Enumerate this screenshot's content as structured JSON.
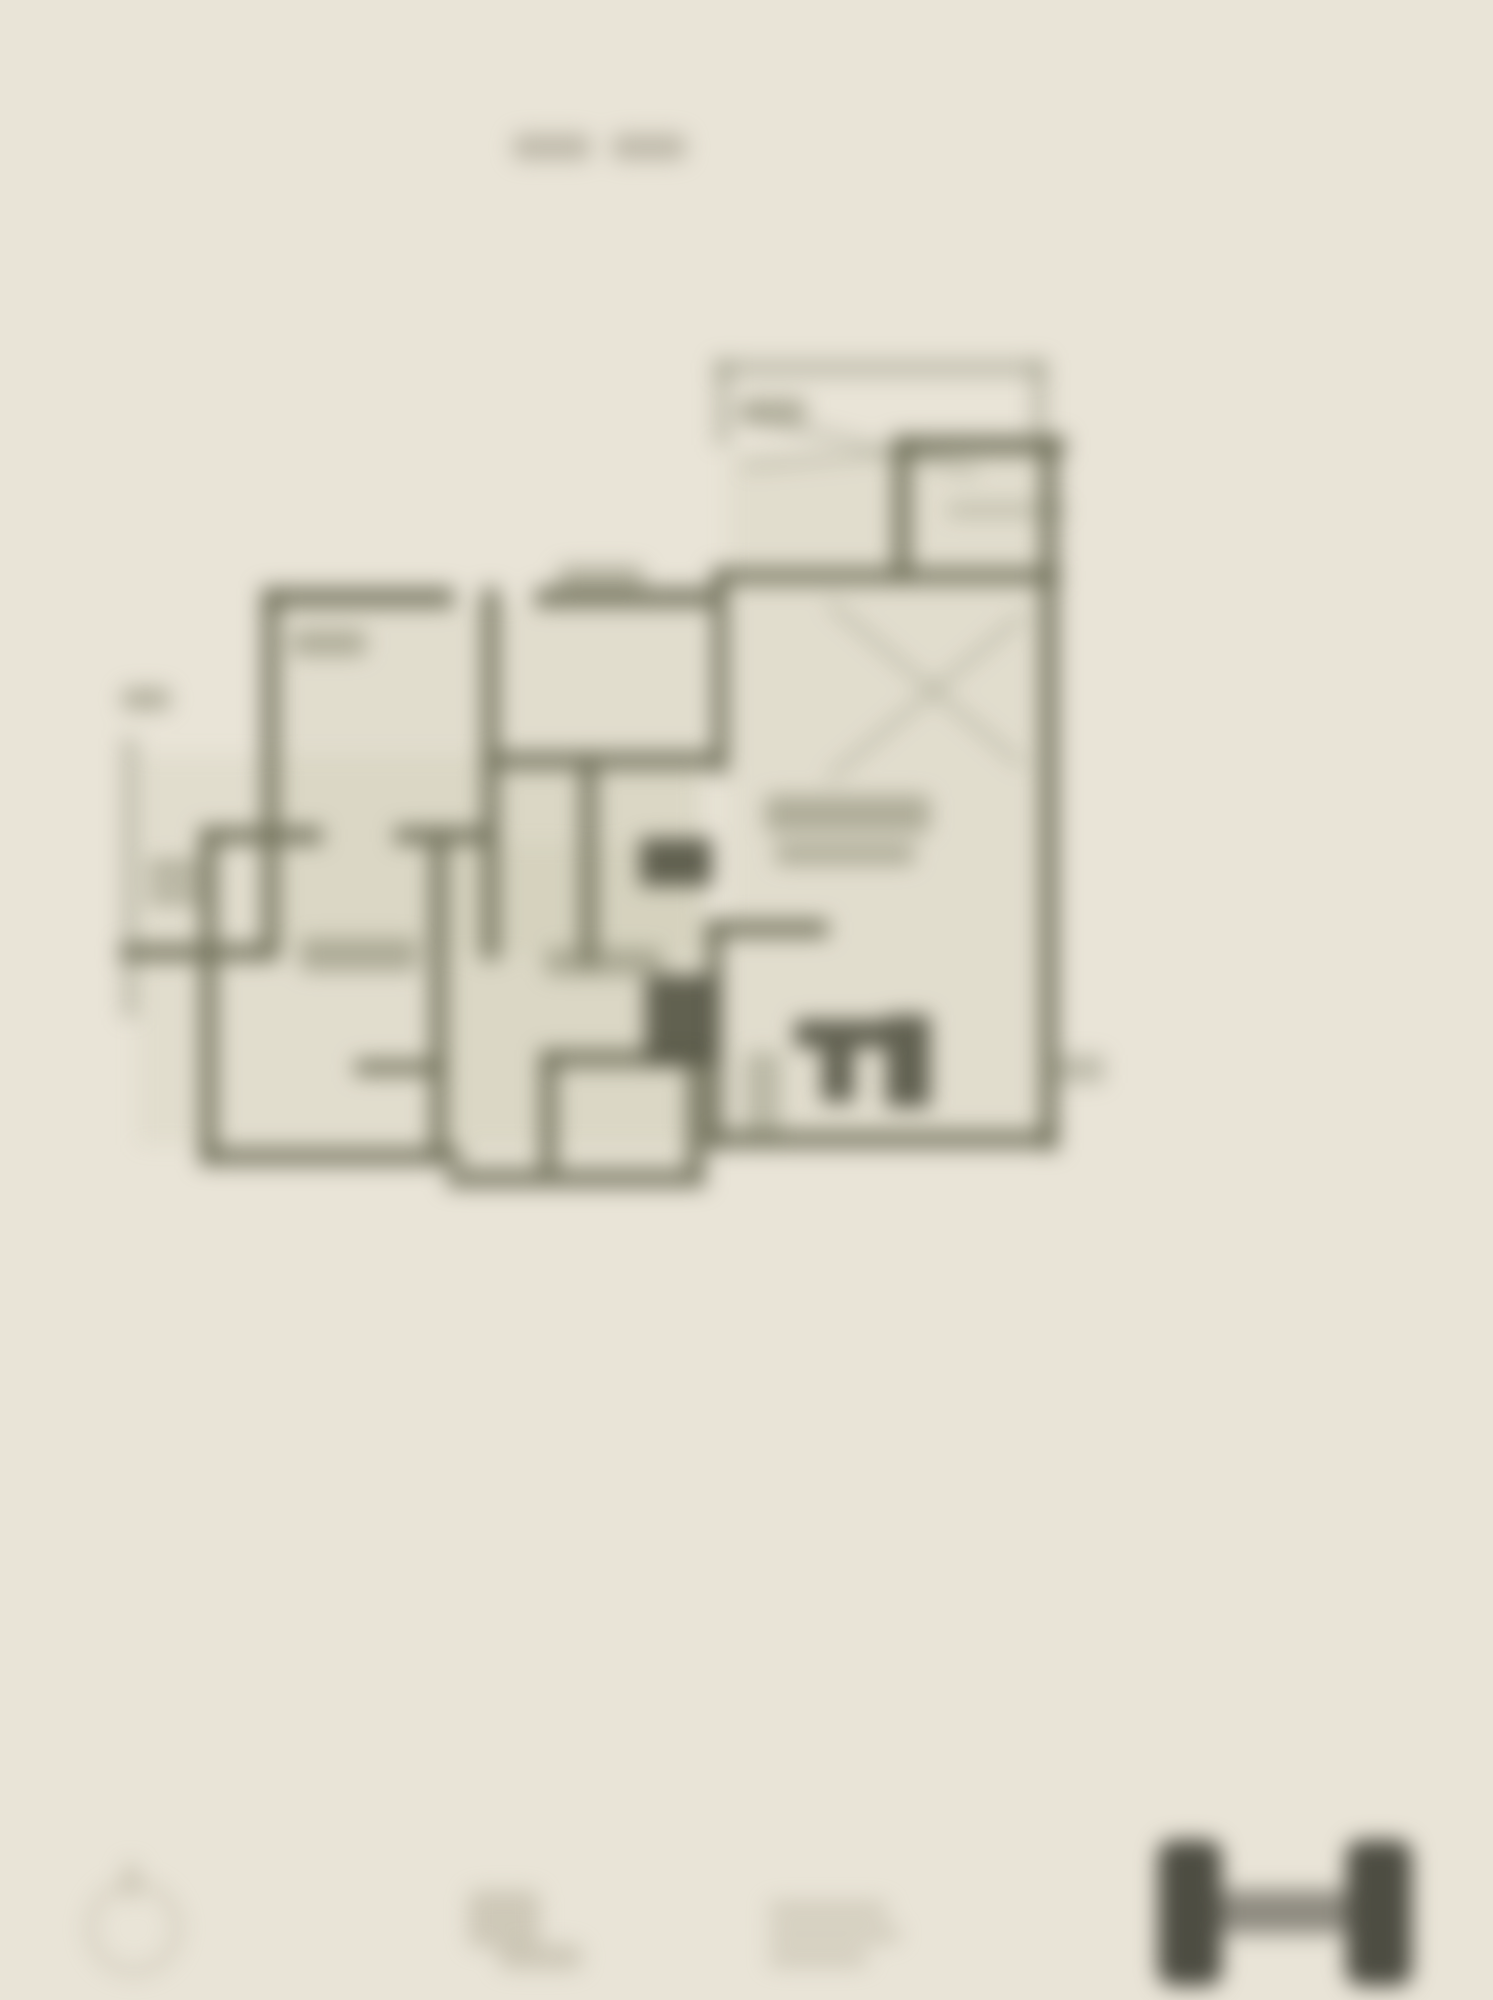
{
  "canvas": {
    "width": 1493,
    "height": 2000,
    "blur_px": 11
  },
  "palette": {
    "background": "#e9e4d7",
    "wall": "#6b6c55",
    "dark": "#565645",
    "label": "#7d7d66",
    "faint": "#b3ad99",
    "logo": "#45443a",
    "title": "#a39f8e",
    "tint": "#b0ac8c"
  },
  "title": {
    "legible": false,
    "blocks": [
      {
        "name": "title-word-1",
        "cls": "titleblk",
        "x": 513,
        "y": 134,
        "w": 78,
        "h": 26
      },
      {
        "name": "title-word-2",
        "cls": "titleblk",
        "x": 612,
        "y": 134,
        "w": 74,
        "h": 26
      }
    ]
  },
  "floor_plan": {
    "type": "architectural-floor-plan",
    "legible_text": false,
    "shapes": [
      {
        "name": "interior-tint-upper-left",
        "cls": "tint",
        "x": 279,
        "y": 605,
        "w": 427,
        "h": 350
      },
      {
        "name": "interior-tint-mid-left",
        "cls": "tint",
        "x": 137,
        "y": 755,
        "w": 560,
        "h": 390
      },
      {
        "name": "interior-tint-right",
        "cls": "tint",
        "x": 728,
        "y": 452,
        "w": 312,
        "h": 679
      },
      {
        "name": "interior-tint-bottom-center",
        "cls": "tint",
        "x": 447,
        "y": 844,
        "w": 259,
        "h": 326
      },
      {
        "name": "terrace-top-wall",
        "cls": "wall2",
        "x": 715,
        "y": 360,
        "w": 330,
        "h": 16
      },
      {
        "name": "terrace-left-wall",
        "cls": "wall2",
        "x": 715,
        "y": 360,
        "w": 15,
        "h": 85
      },
      {
        "name": "terrace-right-wall",
        "cls": "wall2",
        "x": 1032,
        "y": 360,
        "w": 15,
        "h": 85
      },
      {
        "name": "garage-top-wall",
        "cls": "wall",
        "x": 893,
        "y": 436,
        "w": 172,
        "h": 19
      },
      {
        "name": "garage-left-wall",
        "cls": "wall",
        "x": 893,
        "y": 436,
        "w": 18,
        "h": 148
      },
      {
        "name": "outer-right-wall",
        "cls": "wall",
        "x": 1040,
        "y": 436,
        "w": 18,
        "h": 714
      },
      {
        "name": "garage-divider-wall",
        "cls": "wall",
        "x": 712,
        "y": 568,
        "w": 348,
        "h": 16
      },
      {
        "name": "garage-stair-line",
        "cls": "wall2",
        "x": 948,
        "y": 504,
        "w": 118,
        "h": 12
      },
      {
        "name": "garage-diagonal-a",
        "cls": "diag",
        "x": 735,
        "y": 408,
        "w": 250,
        "h": 9,
        "angle": 14
      },
      {
        "name": "garage-diagonal-b",
        "cls": "diag",
        "x": 742,
        "y": 462,
        "w": 240,
        "h": 8,
        "angle": -5
      },
      {
        "name": "garage-note-smudge",
        "cls": "labelsm",
        "x": 742,
        "y": 398,
        "w": 64,
        "h": 26
      },
      {
        "name": "upper-left-top-wall-a",
        "cls": "wall",
        "x": 262,
        "y": 588,
        "w": 192,
        "h": 19
      },
      {
        "name": "upper-left-top-wall-b",
        "cls": "wall",
        "x": 535,
        "y": 588,
        "w": 182,
        "h": 19
      },
      {
        "name": "upper-left-outer-wall",
        "cls": "wall",
        "x": 262,
        "y": 588,
        "w": 17,
        "h": 372
      },
      {
        "name": "bedroom-divider-wall",
        "cls": "wall",
        "x": 482,
        "y": 588,
        "w": 17,
        "h": 372
      },
      {
        "name": "hall-bottom-wall",
        "cls": "wall",
        "x": 482,
        "y": 752,
        "w": 232,
        "h": 17
      },
      {
        "name": "hall-divider-wall",
        "cls": "wall",
        "x": 580,
        "y": 752,
        "w": 17,
        "h": 215
      },
      {
        "name": "living-left-wall",
        "cls": "wall",
        "x": 712,
        "y": 568,
        "w": 16,
        "h": 205
      },
      {
        "name": "exterior-note-smudge",
        "cls": "labelsm",
        "x": 122,
        "y": 688,
        "w": 48,
        "h": 22
      },
      {
        "name": "balcony-left-wall",
        "cls": "wall2",
        "x": 122,
        "y": 738,
        "w": 15,
        "h": 280
      },
      {
        "name": "balcony-bottom-wall",
        "cls": "wall",
        "x": 120,
        "y": 944,
        "w": 152,
        "h": 17
      },
      {
        "name": "bottomleft-left-wall",
        "cls": "wall",
        "x": 200,
        "y": 827,
        "w": 17,
        "h": 338
      },
      {
        "name": "bottomleft-top-wall-a",
        "cls": "wall",
        "x": 200,
        "y": 827,
        "w": 122,
        "h": 17
      },
      {
        "name": "bottomleft-top-wall-b",
        "cls": "wall",
        "x": 395,
        "y": 827,
        "w": 100,
        "h": 17
      },
      {
        "name": "center-divider-wall",
        "cls": "wall",
        "x": 430,
        "y": 827,
        "w": 17,
        "h": 338
      },
      {
        "name": "closet-wall",
        "cls": "wall",
        "x": 355,
        "y": 1060,
        "w": 92,
        "h": 15
      },
      {
        "name": "bottomleft-bottom-wall",
        "cls": "wall",
        "x": 200,
        "y": 1148,
        "w": 262,
        "h": 17
      },
      {
        "name": "stair-top-wall",
        "cls": "wall",
        "x": 540,
        "y": 1050,
        "w": 162,
        "h": 17
      },
      {
        "name": "stair-left-wall",
        "cls": "wall",
        "x": 540,
        "y": 1050,
        "w": 17,
        "h": 122
      },
      {
        "name": "stair-right-wall",
        "cls": "wall",
        "x": 687,
        "y": 1050,
        "w": 17,
        "h": 122
      },
      {
        "name": "center-bottom-wall",
        "cls": "wall",
        "x": 447,
        "y": 1170,
        "w": 258,
        "h": 17
      },
      {
        "name": "bath-top-wall",
        "cls": "wall",
        "x": 706,
        "y": 920,
        "w": 122,
        "h": 17
      },
      {
        "name": "bath-left-wall",
        "cls": "wall",
        "x": 706,
        "y": 920,
        "w": 17,
        "h": 230
      },
      {
        "name": "right-bottom-wall",
        "cls": "wall",
        "x": 706,
        "y": 1131,
        "w": 352,
        "h": 17
      },
      {
        "name": "entry-stub-wall",
        "cls": "wall2",
        "x": 1058,
        "y": 1055,
        "w": 46,
        "h": 28
      },
      {
        "name": "dark-block-upper",
        "cls": "dark",
        "x": 640,
        "y": 838,
        "w": 72,
        "h": 48
      },
      {
        "name": "dark-block-lower",
        "cls": "dark",
        "x": 645,
        "y": 975,
        "w": 70,
        "h": 90
      },
      {
        "name": "living-cross-line-a",
        "cls": "diag",
        "x": 828,
        "y": 598,
        "w": 255,
        "h": 8,
        "angle": 40
      },
      {
        "name": "living-cross-line-b",
        "cls": "diag",
        "x": 828,
        "y": 775,
        "w": 255,
        "h": 8,
        "angle": -40
      },
      {
        "name": "fixture-t-bar",
        "cls": "dark",
        "x": 795,
        "y": 1020,
        "w": 92,
        "h": 28
      },
      {
        "name": "fixture-t-stem",
        "cls": "dark",
        "x": 822,
        "y": 1048,
        "w": 32,
        "h": 54
      },
      {
        "name": "fixture-left-band",
        "cls": "wall2",
        "x": 745,
        "y": 1052,
        "w": 36,
        "h": 96
      },
      {
        "name": "fixture-right-band",
        "cls": "dark",
        "x": 886,
        "y": 1015,
        "w": 44,
        "h": 92
      },
      {
        "name": "label-bedroom-left",
        "cls": "labelsm",
        "x": 292,
        "y": 630,
        "w": 74,
        "h": 26
      },
      {
        "name": "label-bedroom-mid",
        "cls": "labelsm",
        "x": 558,
        "y": 566,
        "w": 86,
        "h": 30
      },
      {
        "name": "label-room-bottomleft",
        "cls": "labelsm",
        "x": 300,
        "y": 938,
        "w": 118,
        "h": 34
      },
      {
        "name": "label-living-line-1",
        "cls": "labelsm",
        "x": 765,
        "y": 795,
        "w": 165,
        "h": 38
      },
      {
        "name": "label-living-line-2",
        "cls": "labelsm",
        "x": 775,
        "y": 843,
        "w": 140,
        "h": 22
      },
      {
        "name": "label-small-left-1",
        "cls": "labelsm",
        "x": 148,
        "y": 860,
        "w": 70,
        "h": 20
      },
      {
        "name": "label-small-left-2",
        "cls": "labelsm",
        "x": 148,
        "y": 886,
        "w": 58,
        "h": 18
      },
      {
        "name": "label-small-center",
        "cls": "labelsm",
        "x": 545,
        "y": 948,
        "w": 118,
        "h": 28
      }
    ]
  },
  "footer": {
    "shapes": [
      {
        "name": "compass-ring",
        "cls": "ring2",
        "x": 86,
        "y": 1880,
        "w": 96,
        "h": 96
      },
      {
        "name": "compass-needle",
        "cls": "faintblob",
        "x": 124,
        "y": 1862,
        "w": 14,
        "h": 36
      },
      {
        "name": "scale-figure-blob",
        "cls": "faintblob",
        "x": 468,
        "y": 1890,
        "w": 72,
        "h": 58
      },
      {
        "name": "scale-bar-blob",
        "cls": "faintblob",
        "x": 498,
        "y": 1944,
        "w": 84,
        "h": 26
      },
      {
        "name": "note-text-line-1",
        "cls": "faintblob",
        "x": 768,
        "y": 1902,
        "w": 120,
        "h": 16
      },
      {
        "name": "note-text-line-2",
        "cls": "faintblob",
        "x": 768,
        "y": 1926,
        "w": 132,
        "h": 16
      },
      {
        "name": "note-text-line-3",
        "cls": "faintblob",
        "x": 768,
        "y": 1950,
        "w": 100,
        "h": 16
      },
      {
        "name": "logo-bar-left",
        "cls": "logo",
        "x": 1158,
        "y": 1840,
        "w": 64,
        "h": 146
      },
      {
        "name": "logo-connector",
        "cls": "logolite",
        "x": 1222,
        "y": 1890,
        "w": 124,
        "h": 44
      },
      {
        "name": "logo-bar-right",
        "cls": "logo",
        "x": 1346,
        "y": 1840,
        "w": 66,
        "h": 146
      }
    ]
  }
}
